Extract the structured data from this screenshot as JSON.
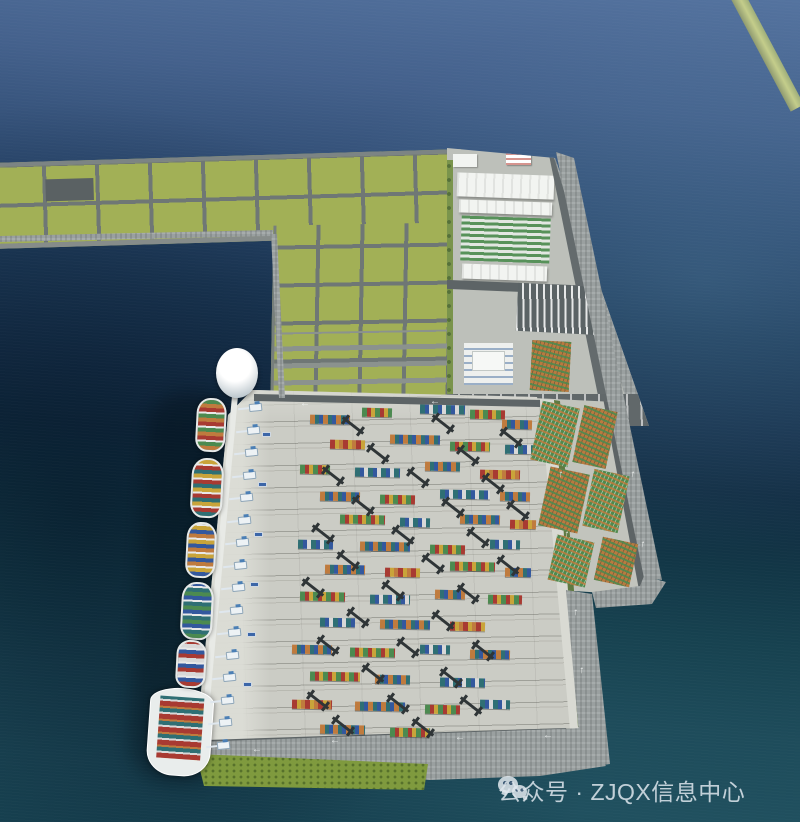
{
  "watermark": {
    "icon": "wechat-icon",
    "text": "公众号 · ZJQX信息中心"
  },
  "palette": {
    "ocean_top": "#54739f",
    "ocean_mid": "#16304b",
    "ocean_teal": "#1e4c5b",
    "field_green": "#a2b056",
    "grid_road": "#6f7775",
    "road_gray": "#5d6466",
    "yard_gray": "#cbccc5",
    "seawall_gray": "#9aa0a0",
    "grass_green": "#7f9a3e",
    "hedge_green": "#5f7a42",
    "warehouse_white": "#f2f4f1",
    "crane_dark": "#2f3537",
    "quay_crane": "#edf2f5",
    "quay_crane_blue": "#4b7fb5",
    "breakwater": "#c4cd8b"
  },
  "container_colors": [
    "#bf7b3e",
    "#4c8a50",
    "#2f6f74",
    "#a83a32",
    "#33589e",
    "#c9a43a",
    "#d8d8d8"
  ],
  "scene": {
    "terminal": {
      "stacks": [
        [
          310,
          415,
          40,
          0
        ],
        [
          362,
          408,
          30,
          1
        ],
        [
          420,
          405,
          45,
          2
        ],
        [
          470,
          410,
          35,
          1
        ],
        [
          502,
          420,
          30,
          0
        ],
        [
          330,
          440,
          35,
          3
        ],
        [
          390,
          435,
          50,
          0
        ],
        [
          450,
          442,
          40,
          1
        ],
        [
          505,
          445,
          28,
          2
        ],
        [
          300,
          465,
          30,
          1
        ],
        [
          355,
          468,
          45,
          2
        ],
        [
          425,
          462,
          35,
          0
        ],
        [
          480,
          470,
          40,
          3
        ],
        [
          320,
          492,
          40,
          0
        ],
        [
          380,
          495,
          35,
          1
        ],
        [
          440,
          490,
          50,
          2
        ],
        [
          500,
          492,
          30,
          0
        ],
        [
          340,
          515,
          45,
          1
        ],
        [
          400,
          518,
          30,
          2
        ],
        [
          460,
          515,
          40,
          0
        ],
        [
          510,
          520,
          26,
          3
        ],
        [
          298,
          540,
          35,
          2
        ],
        [
          360,
          542,
          50,
          0
        ],
        [
          430,
          545,
          35,
          1
        ],
        [
          490,
          540,
          30,
          2
        ],
        [
          325,
          565,
          40,
          0
        ],
        [
          385,
          568,
          35,
          3
        ],
        [
          450,
          562,
          45,
          1
        ],
        [
          505,
          568,
          26,
          0
        ],
        [
          300,
          592,
          45,
          1
        ],
        [
          370,
          595,
          40,
          2
        ],
        [
          435,
          590,
          30,
          0
        ],
        [
          488,
          595,
          34,
          1
        ],
        [
          320,
          618,
          35,
          2
        ],
        [
          380,
          620,
          50,
          0
        ],
        [
          450,
          622,
          35,
          3
        ],
        [
          292,
          645,
          40,
          0
        ],
        [
          350,
          648,
          45,
          1
        ],
        [
          420,
          645,
          30,
          2
        ],
        [
          470,
          650,
          40,
          0
        ],
        [
          310,
          672,
          50,
          1
        ],
        [
          375,
          675,
          35,
          0
        ],
        [
          440,
          678,
          45,
          2
        ],
        [
          292,
          700,
          40,
          3
        ],
        [
          355,
          702,
          50,
          0
        ],
        [
          425,
          705,
          35,
          1
        ],
        [
          480,
          700,
          30,
          2
        ],
        [
          320,
          725,
          45,
          0
        ],
        [
          390,
          728,
          40,
          1
        ]
      ],
      "cranes": [
        [
          340,
          420
        ],
        [
          430,
          418
        ],
        [
          498,
          432
        ],
        [
          365,
          448
        ],
        [
          455,
          450
        ],
        [
          320,
          470
        ],
        [
          405,
          472
        ],
        [
          480,
          478
        ],
        [
          350,
          500
        ],
        [
          440,
          502
        ],
        [
          505,
          505
        ],
        [
          310,
          528
        ],
        [
          390,
          530
        ],
        [
          465,
          532
        ],
        [
          335,
          555
        ],
        [
          420,
          558
        ],
        [
          495,
          560
        ],
        [
          300,
          582
        ],
        [
          380,
          585
        ],
        [
          455,
          588
        ],
        [
          345,
          612
        ],
        [
          430,
          615
        ],
        [
          315,
          640
        ],
        [
          395,
          642
        ],
        [
          470,
          645
        ],
        [
          360,
          668
        ],
        [
          438,
          672
        ],
        [
          305,
          695
        ],
        [
          385,
          698
        ],
        [
          458,
          700
        ],
        [
          330,
          720
        ],
        [
          410,
          722
        ]
      ],
      "carriers": [
        [
          262,
          432
        ],
        [
          258,
          482
        ],
        [
          254,
          532
        ],
        [
          250,
          582
        ],
        [
          247,
          632
        ],
        [
          243,
          682
        ]
      ]
    },
    "quay": {
      "crane_count": 16,
      "crane_start": [
        238,
        402
      ],
      "crane_end": [
        206,
        740
      ],
      "ships": [
        [
          196,
          398,
          30,
          54,
          0
        ],
        [
          191,
          458,
          32,
          60,
          2
        ],
        [
          186,
          522,
          30,
          56,
          4
        ],
        [
          181,
          582,
          32,
          58,
          1
        ],
        [
          176,
          640,
          30,
          48,
          3
        ]
      ]
    },
    "stacks_band": {
      "blocks": [
        [
          536,
          404,
          38,
          60,
          0
        ],
        [
          578,
          408,
          34,
          58,
          1
        ],
        [
          544,
          470,
          40,
          60,
          1
        ],
        [
          588,
          472,
          36,
          58,
          0
        ],
        [
          552,
          538,
          38,
          46,
          0
        ],
        [
          598,
          540,
          36,
          44,
          1
        ]
      ]
    },
    "arrows": [
      [
        300,
        399,
        "←",
        0
      ],
      [
        430,
        397,
        "←",
        0
      ],
      [
        252,
        745,
        "←",
        0
      ],
      [
        330,
        736,
        "←",
        0
      ],
      [
        455,
        733,
        "←",
        0
      ],
      [
        543,
        731,
        "←",
        0
      ],
      [
        558,
        470,
        "↑",
        10
      ],
      [
        564,
        530,
        "↑",
        10
      ],
      [
        573,
        608,
        "↑",
        8
      ],
      [
        579,
        666,
        "↑",
        8
      ],
      [
        630,
        470,
        "↑",
        12
      ],
      [
        640,
        540,
        "↑",
        12
      ]
    ]
  }
}
